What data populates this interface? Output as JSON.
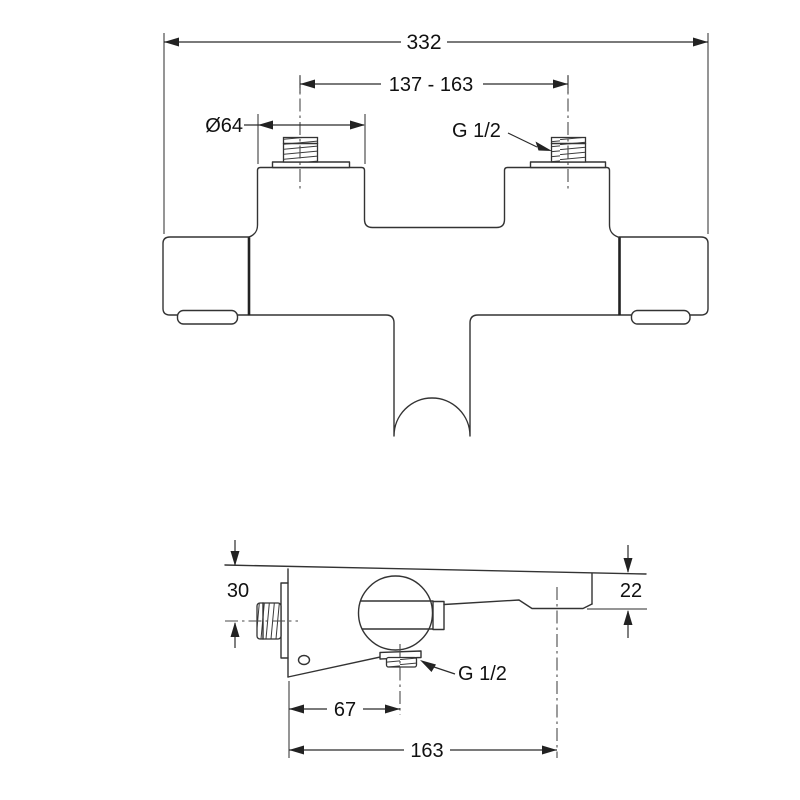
{
  "drawing": {
    "type": "technical-dimension-drawing",
    "subject": "wall-mounted bath shower mixer tap, front and side elevation",
    "background_color": "#ffffff",
    "line_color": "#333333",
    "text_color": "#111111"
  },
  "front_view": {
    "dim_total_width": "332",
    "dim_connection_spacing": "137 - 163",
    "dim_escutcheon_diameter": "Ø64",
    "label_thread_size": "G 1/2"
  },
  "side_view": {
    "dim_top_to_inlet_center": "30",
    "dim_spout_end_height": "22",
    "dim_wall_to_outlet_center": "67",
    "dim_wall_to_spout_center": "163",
    "label_thread_size": "G 1/2"
  }
}
